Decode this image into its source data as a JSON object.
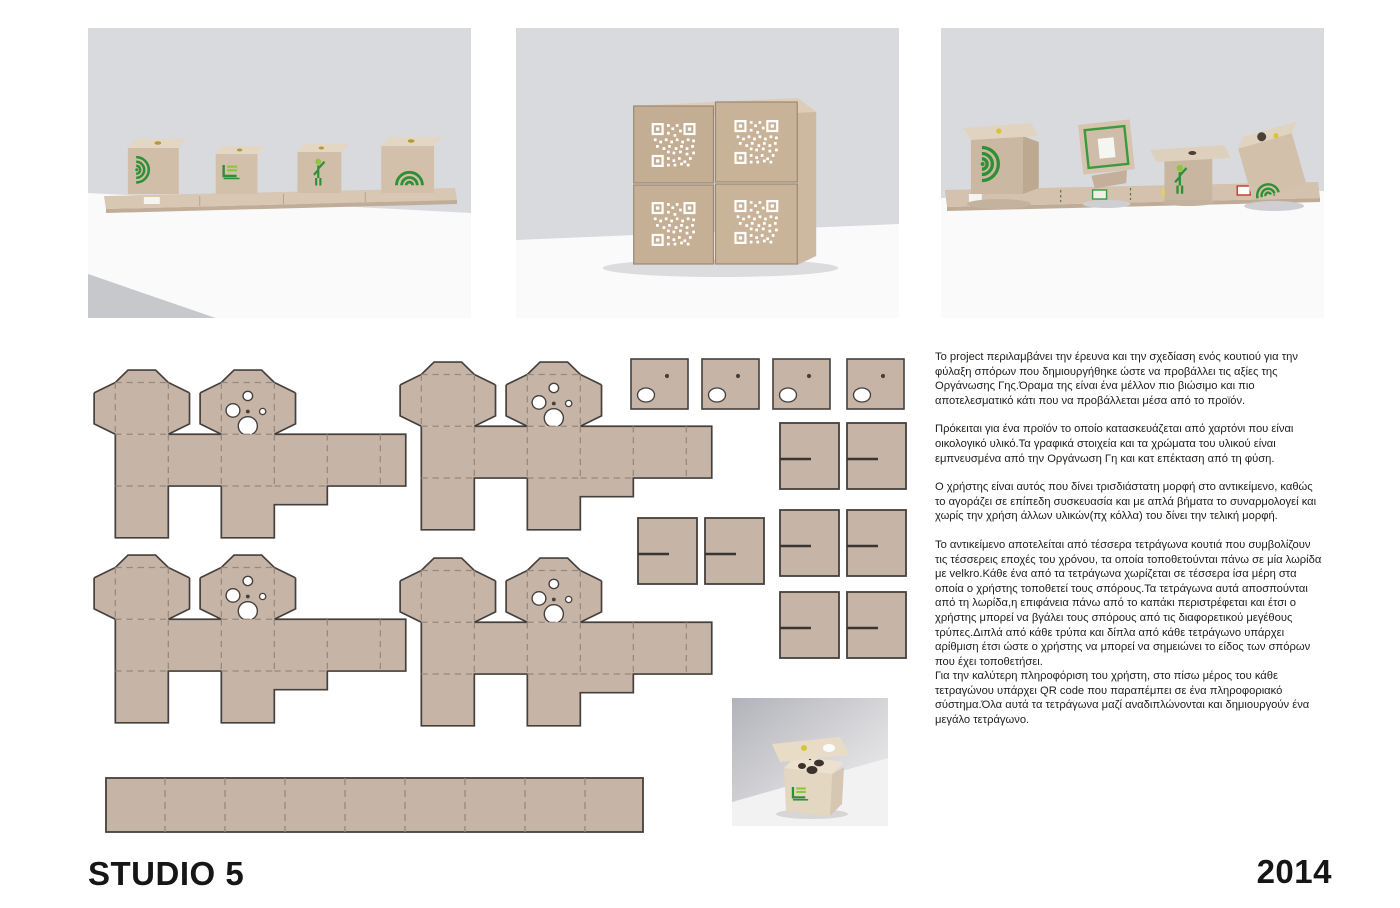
{
  "footer": {
    "studio_label": "STUDIO 5",
    "year_label": "2014"
  },
  "description": {
    "paragraphs": [
      "Το project περιλαμβάνει την έρευνα και την σχεδίαση ενός κουτιού για την φύλαξη σπόρων που δημιουργήθηκε ώστε να προβάλλει τις αξίες της Οργάνωσης Γης.Όραμα της είναι ένα μέλλον πιο βιώσιμο και πιο αποτελεσματικό κάτι που να προβάλλεται μέσα από το προϊόν.",
      "Πρόκειται για ένα προϊόν το οποίο κατασκευάζεται από χαρτόνι που είναι οικολογικό υλικό.Τα γραφικά στοιχεία και τα χρώματα του υλικού είναι εμπνευσμένα από την Οργάνωση Γη και κατ επέκταση από τη φύση.",
      "Ο χρήστης είναι αυτός που δίνει τρισδιάστατη μορφή στο αντικείμενο, καθώς το αγοράζει σε επίπεδη συσκευασία και με απλά βήματα το συναρμολογεί και χωρίς την χρήση άλλων υλικών(πχ κόλλα) του δίνει την τελική μορφή.",
      "Το αντικείμενο αποτελείται από τέσσερα τετράγωνα κουτιά που συμβολίζουν τις τέσσερεις εποχές του χρόνου, τα οποία τοποθετούνται πάνω σε μία λωρίδα με velkro.Κάθε ένα από τα τετράγωνα χωρίζεται σε τέσσερα ίσα μέρη στα οποία ο χρήστης τοποθετεί τους σπόρους.Τα τετράγωνα αυτά αποσπούνται από τη λωρίδα,η επιφάνεια πάνω από το καπάκι περιστρέφεται και έτσι ο χρήστης μπορεί να βγάλει τους σπόρους από τις διαφορετικού μεγέθους τρύπες.Διπλά από κάθε τρύπα και δίπλα από κάθε τετράγωνο υπάρχει αρίθμιση έτσι ώστε ο χρήστης να μπορεί να σημειώνει το είδος των σπόρων που έχει τοποθετήσει.\nΓια την καλύτερη πληροφόριση του χρήστη, στο πίσω μέρος του κάθε τετραγώνου υπάρχει QR code που παραπέμπει σε ένα πληροφοριακό σύστημα.Όλα αυτά τα τετράγωνα μαζί αναδιπλώνονται και δημιουργούν ένα μεγάλο τετράγωνο."
    ]
  },
  "photos": {
    "photo1_label": "four-seed-boxes-on-velcro-strip",
    "photo2_label": "four-boxes-stacked-with-qr-codes",
    "photo3_label": "boxes-lifted-above-strip",
    "photo4_label": "single-box-with-open-lid"
  },
  "diecut": {
    "large_templates": 4,
    "small_hole_squares": 4,
    "slit_square_pairs": 4,
    "strip_segments": 9
  },
  "colors": {
    "template_fill": "#c6b4a7",
    "template_outline": "#45403c",
    "cardboard_photo": "#d2c0ab",
    "photo_background": "#d9dade",
    "accent_green": "#2f8f35",
    "accent_green_light": "#8cc63f",
    "text": "#1d1d1b"
  }
}
